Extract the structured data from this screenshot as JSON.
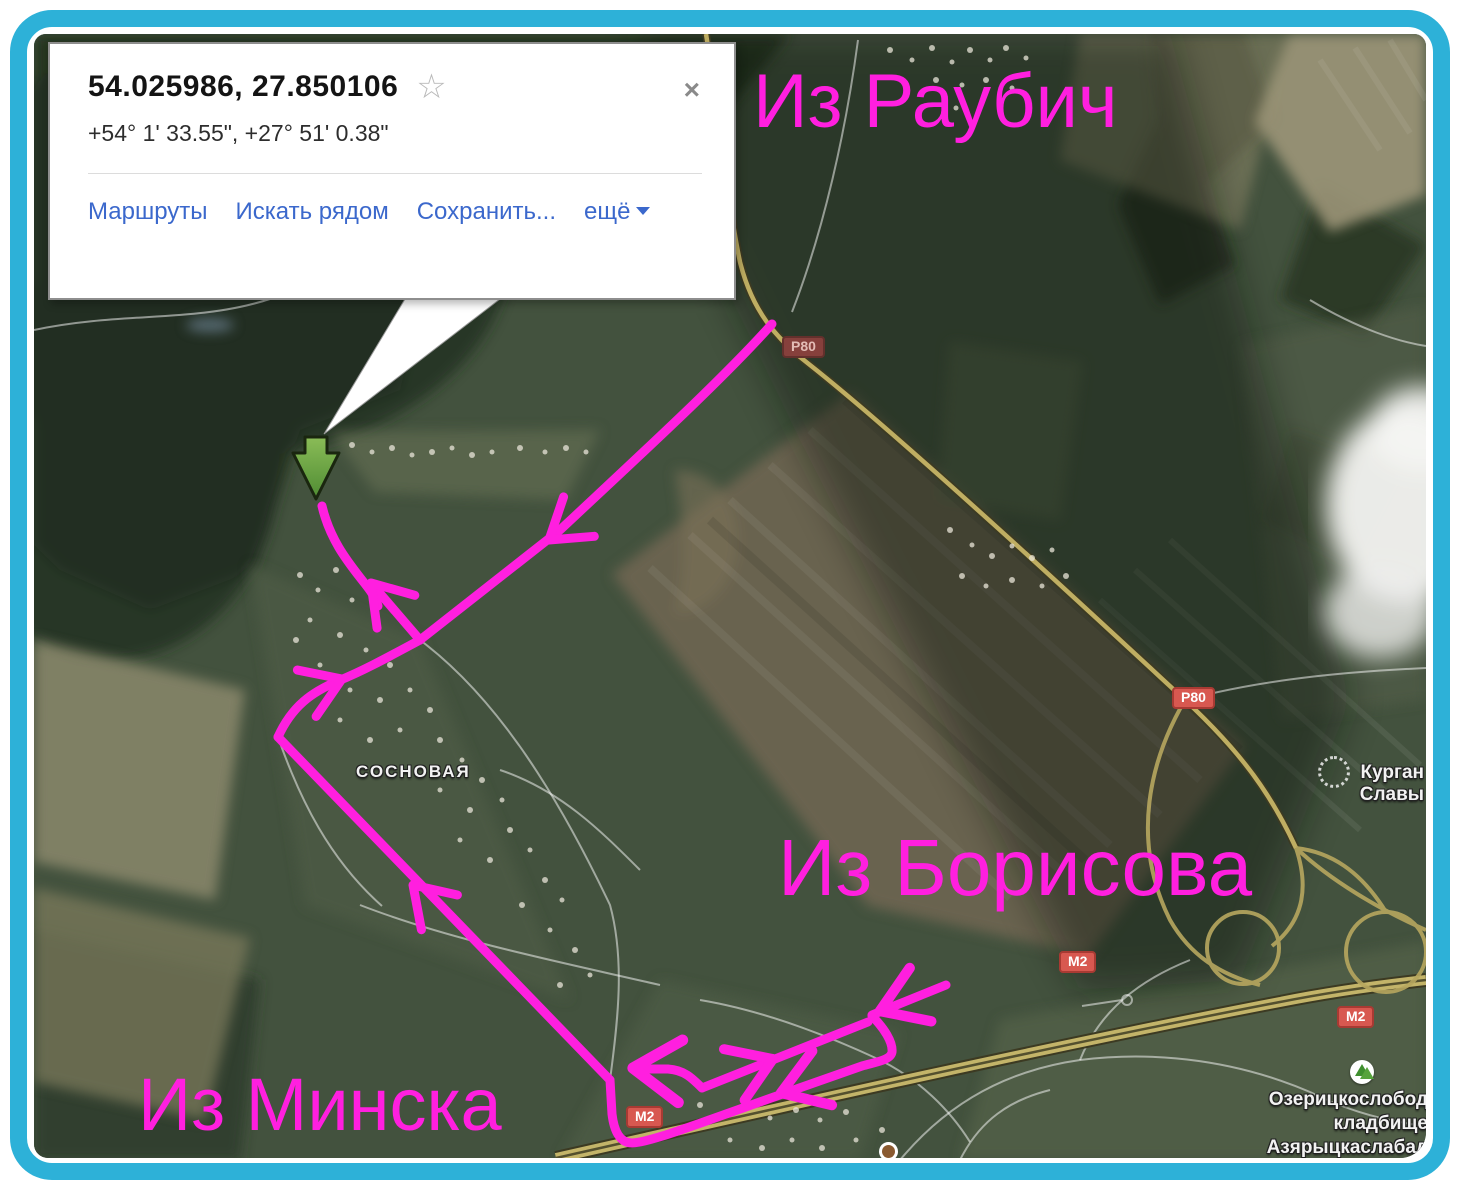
{
  "colors": {
    "frame-color": "#2db1d8",
    "route-color": "#ff1fdf",
    "link-color": "#3b68cc",
    "badge-red": "#d85850",
    "marker-green": "#6fae45"
  },
  "popup": {
    "title": "54.025986, 27.850106",
    "star_icon": "☆",
    "close_icon": "×",
    "dms": "+54° 1' 33.55\", +27° 51' 0.38\"",
    "links": {
      "routes": "Маршруты",
      "search_nearby": "Искать рядом",
      "save": "Сохранить...",
      "more": "ещё"
    }
  },
  "annotations": {
    "from_raubichi": "Из Раубич",
    "from_borisov": "Из Борисова",
    "from_minsk": "Из Минска"
  },
  "map_labels": {
    "village": "СОСНОВАЯ",
    "kurgan_line1": "Курган",
    "kurgan_line2": "Славы",
    "cemetery_line1": "Озерицкослобод",
    "cemetery_line2": "кладбище",
    "cemetery_line3": "Азярыцкаслабад"
  },
  "road_badges": {
    "p80": "P80",
    "m2": "M2"
  }
}
